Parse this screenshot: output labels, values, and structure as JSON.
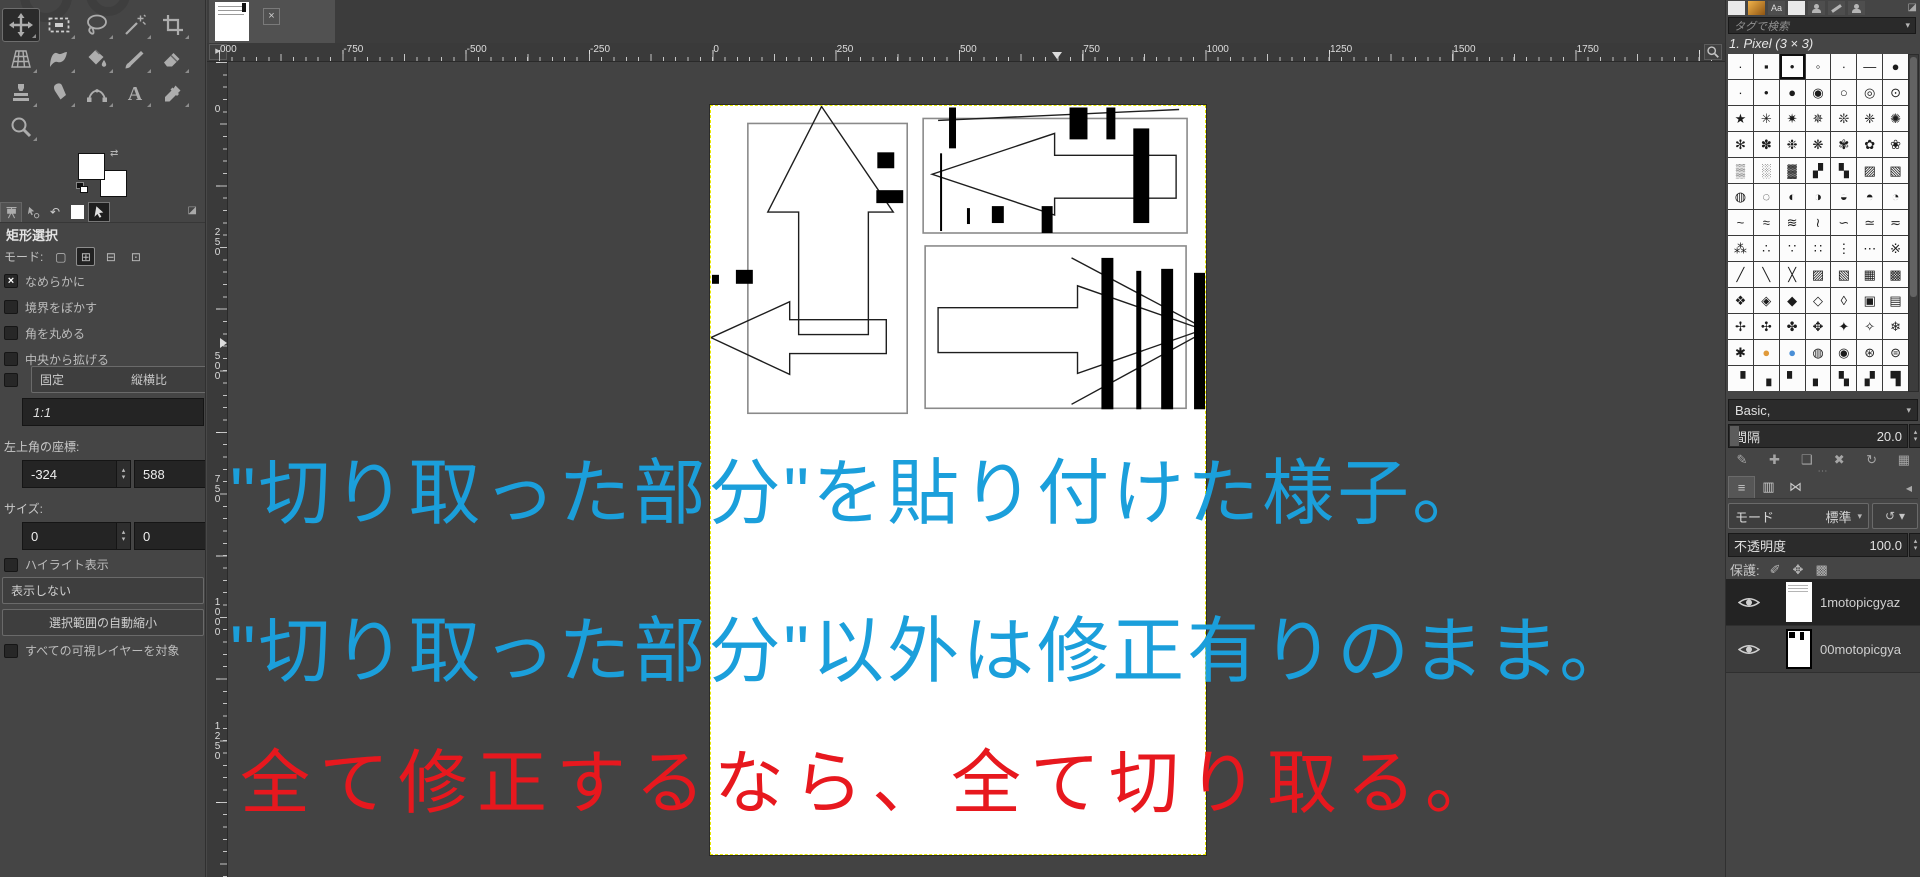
{
  "toolbox": {
    "tools": [
      {
        "name": "move",
        "icon": "#i-move"
      },
      {
        "name": "rectangle-select",
        "icon": "#i-rect"
      },
      {
        "name": "free-select",
        "icon": "#i-lasso"
      },
      {
        "name": "fuzzy-select",
        "icon": "#i-wand"
      },
      {
        "name": "crop",
        "icon": "#i-crop"
      },
      {
        "name": "perspective",
        "icon": "#i-persp"
      },
      {
        "name": "warp-transform",
        "icon": "#i-warp"
      },
      {
        "name": "bucket-fill",
        "icon": "#i-bucket"
      },
      {
        "name": "paintbrush",
        "icon": "#i-brush"
      },
      {
        "name": "eraser",
        "icon": "#i-eraser"
      },
      {
        "name": "clone",
        "icon": "#i-stamp"
      },
      {
        "name": "smudge",
        "icon": "#i-smudge"
      },
      {
        "name": "paths",
        "icon": "#i-paths"
      },
      {
        "name": "text",
        "icon": "#i-text"
      },
      {
        "name": "color-picker",
        "icon": "#i-picker"
      },
      {
        "name": "zoom",
        "icon": "#i-zoom"
      }
    ]
  },
  "tool_options": {
    "title": "矩形選択",
    "mode_label": "モード:",
    "mode_buttons": [
      "▢",
      "⊞",
      "⊟",
      "⊡"
    ],
    "checkboxes": [
      {
        "label": "なめらかに",
        "mark": "×"
      },
      {
        "label": "境界をぼかす",
        "mark": ""
      },
      {
        "label": "角を丸める",
        "mark": ""
      },
      {
        "label": "中央から拡げる",
        "mark": ""
      }
    ],
    "fixed_label": "固定",
    "fixed_value": "縦横比",
    "aspect_value": "1:1",
    "position_label": "左上角の座標:",
    "position_x": "-324",
    "position_y": "588",
    "size_label": "サイズ:",
    "size_w": "0",
    "size_h": "0",
    "highlight_label": "ハイライト表示",
    "highlight_mark": "",
    "guides_value": "表示しない",
    "shrink_button": "選択範囲の自動縮小",
    "sample_merged_label": "すべての可視レイヤーを対象",
    "sample_merged_mark": ""
  },
  "canvas": {
    "tab_close": "×",
    "h_ruler_labels": [
      "000",
      "-750",
      "-500",
      "-250",
      "0",
      "250",
      "500",
      "750",
      "1000",
      "1250",
      "1500",
      "1750"
    ],
    "v_ruler_labels": [
      "0",
      "250",
      "500",
      "750",
      "1000",
      "1250"
    ],
    "overlay_texts": [
      {
        "text": "\"切り取った部分\"を貼り付けた様子。",
        "color": "#1b9fdb"
      },
      {
        "text": "\"切り取った部分\"以外は修正有りのまま。",
        "color": "#1b9fdb"
      },
      {
        "text": "全て修正するなら、全て切り取る。",
        "color": "#e7181e"
      }
    ]
  },
  "brushes": {
    "search_placeholder": "タグで検索",
    "selected_brush": "1. Pixel (3 × 3)",
    "grid": "·▪•◦∙—●∙•●◉○◎⊙★✳✷✵❊❈✺✻✽❉❋✾✿❀▒░▓▞▚▨▧◍◌◐◑◒◓◔~≈≋≀∽≃≂⁂∴∵∷⋮⋯※╱╲╳▨▧▦▩❖◈◆◇◊▣▤✢✣✤✥✦✧❄✱●●◍◉⊛⊜▝▗▘▖▚▞▜",
    "grid_colors": {
      "78": "#e09a3a",
      "79": "#4a8fd6"
    },
    "selected_index": 2,
    "dialog_tabs": [
      {
        "kind": "white",
        "name": "brushes-dialog-tab"
      },
      {
        "kind": "orange",
        "name": "patterns-dialog-tab"
      },
      {
        "kind": "text",
        "label": "Aa",
        "name": "fonts-dialog-tab"
      },
      {
        "kind": "white",
        "name": "gradients-dialog-tab"
      },
      {
        "kind": "bust",
        "name": "history-dialog-tab"
      },
      {
        "kind": "brushstroke",
        "name": "paint-dynamics-dialog-tab"
      },
      {
        "kind": "bust",
        "name": "document-history-dialog-tab"
      }
    ],
    "group_value": "Basic,",
    "spacing_label": "間隔",
    "spacing_value": "20.0",
    "action_icons": [
      "✎",
      "✚",
      "❑",
      "✖",
      "↻",
      "▦"
    ]
  },
  "layers_panel": {
    "dock_tabs": [
      "≡",
      "▥",
      "⋈"
    ],
    "mode_label": "モード",
    "mode_value": "標準",
    "opacity_label": "不透明度",
    "opacity_value": "100.0",
    "lock_label": "保護:",
    "lock_icons": [
      "✐",
      "✥",
      "▩"
    ],
    "layers": [
      {
        "name": "1motopicgyaz",
        "thumb": "sketch"
      },
      {
        "name": "00motopicgya",
        "thumb": "marked"
      }
    ]
  },
  "icons": {
    "chevron_down": "▾",
    "spin_up": "▴",
    "spin_down": "▾",
    "ruler_origin": "▶",
    "menu_corner": "◪",
    "dock_collapse": "◀",
    "undo_history_tab": "↶",
    "handle_dots": "⋯",
    "reset_mode": "↺",
    "swap_colors": "⇄"
  }
}
